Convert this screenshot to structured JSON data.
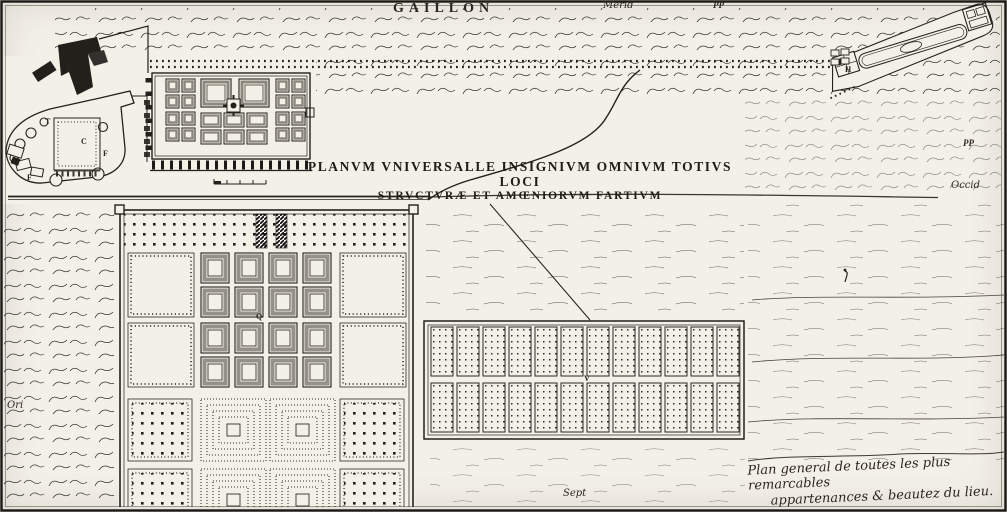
{
  "colors": {
    "paper": "#f3f0e8",
    "ink": "#201d18"
  },
  "title": {
    "text": "GAILLON"
  },
  "captions": {
    "latin_line1": "PLANVM VNIVERSALLE INSIGNIVM OMNIVM TOTIVS LOCI",
    "latin_line2": "STRVCTVRÆ ET AMŒNIORVM FARTIVM",
    "french_line1": "Plan general de toutes les plus remarcables",
    "french_line2": "appartenances & beautez du lieu."
  },
  "compass": {
    "south": "Merid",
    "west": "Occid",
    "east": "Ori",
    "north": "Sept"
  },
  "markers": {
    "pp_top": "PP",
    "pp_right": "PP"
  },
  "plan_letters": {
    "e": "E",
    "t": "T",
    "c": "C",
    "f": "F",
    "q": "Q",
    "v": "V",
    "h": "H"
  }
}
